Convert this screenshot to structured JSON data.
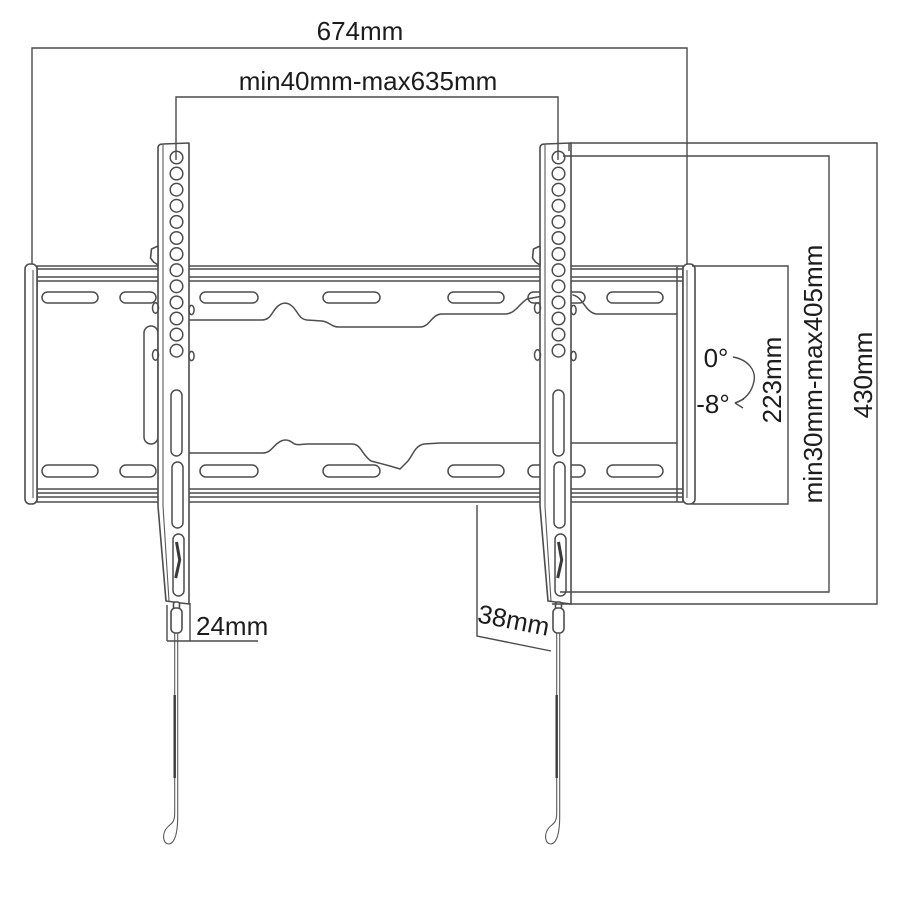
{
  "colors": {
    "background": "#ffffff",
    "drawing_line": "#4d4d4d",
    "dimension_line": "#4a4a4a",
    "text": "#1c1c1c"
  },
  "dims": {
    "total_width": "674mm",
    "vesa_width_range": "min40mm-max635mm",
    "plate_height": "223mm",
    "vesa_height_range": "min30mm-max405mm",
    "bracket_height": "430mm",
    "tilt_upper": "0°",
    "tilt_lower": "-8°",
    "bottom_left_offset": "24mm",
    "bottom_right_offset": "38mm"
  }
}
